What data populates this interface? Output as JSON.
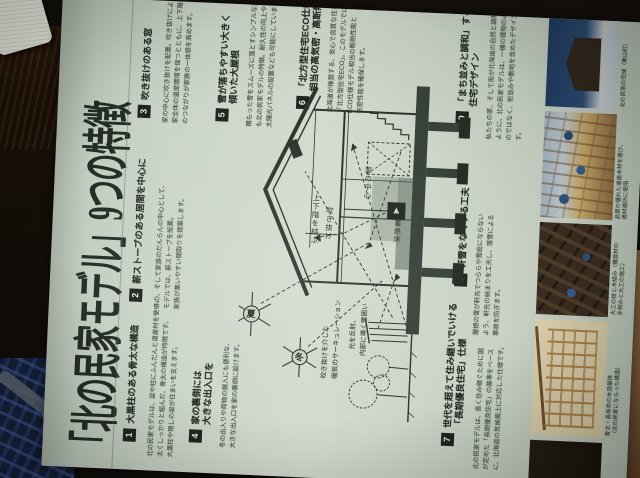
{
  "page": {
    "title": "「北の民家モデル」9つの特徴"
  },
  "colors": {
    "paper": "#ccd5c9",
    "ink": "#2c342c",
    "number_square": "#20261f",
    "table_wood": "#7b5a3a",
    "chair_blue": "#141f38"
  },
  "sections": [
    {
      "num": "1",
      "heading": [
        "大黒柱のある骨太な構造"
      ],
      "body": [
        "北の民家モデルは、梁や柱にふんだんと道産材を使い、",
        "太くしっかりと組んだ、骨太の構造が特徴です。",
        "大黒柱や現しの梁が住まいを支えます。"
      ]
    },
    {
      "num": "2",
      "heading": [
        "薪ストーブのある居間を中心に"
      ],
      "body": [
        "冬の、そして家族のだんらんの中心として、",
        "モデルでは、薪ストーブを設置。",
        "家族が集いやすい間取りを提案します。"
      ]
    },
    {
      "num": "3",
      "heading": [
        "吹き抜けのある窓"
      ],
      "body": [
        "家の中心に吹き抜けを配置。吹き抜けにより、",
        "家全体の温度環境を保つとともに、上下階",
        "のつながりが家族の一体感を高めます。"
      ]
    },
    {
      "num": "4",
      "heading": [
        "家の裏側には",
        "大きな出入口を"
      ],
      "body": [
        "冬の出入りや荷物の搬入にも便利な、",
        "大きな出入口を家の裏側に設けます。"
      ]
    },
    {
      "num": "5",
      "heading": [
        "雪が落ちやすい大きく",
        "傾いた大屋根"
      ],
      "body": [
        "積もった雪をスムーズに落とすシンプルな形",
        "も北の民家モデルの特徴。耐久性の向上や、",
        "太陽光パネルの設置なども可能にしています。"
      ]
    },
    {
      "num": "6",
      "heading": [
        "「北方型住宅ECO仕様」",
        "相当の高気密・高断熱"
      ],
      "body": [
        "北海道が推奨する、安心で良質な住まい",
        "「北方型住宅ECO」。このモデルでは、",
        "ECO仕様モデル相当の断熱性能と",
        "気密性能を確保します。"
      ]
    },
    {
      "num": "7",
      "heading": [
        "世代を超えて住み継いでいける",
        "「長期優良住宅」仕様"
      ],
      "body": [
        "北の民家モデルは、長く住み継ぐために国",
        "が定めた「長期優良住宅」の基準をベース",
        "に、北海道の気候風土に対応した仕様です。"
      ]
    },
    {
      "num": "8",
      "heading": [
        "軒雪をなくする工夫"
      ],
      "body": [
        "屋根の雪が軒先でつららや雪庇にならない",
        "よう、軒先の納まりを工夫し、落雪による",
        "事故を防ぎます。"
      ]
    },
    {
      "num": "9",
      "heading": [
        "「まち並みと調和」する",
        "住宅デザイン"
      ],
      "body": [
        "私たちの家、そして街が北海道の自然と調和する",
        "ように、北の民家モデルは、一棟の建物のみを考える",
        "のではなく、街並みや敷地を含めたデザインとしま",
        "す。"
      ]
    }
  ],
  "diagram": {
    "label_void_1": "上下階を結ぶ",
    "label_void_2": "吹き抜け",
    "label_center": "家の中心",
    "label_floor": "蓄熱床",
    "label_circ_1": "吹き抜けを介した",
    "label_circ_2": "暖気のサーキュレーション",
    "label_light_1": "光を反射、",
    "label_light_2": "内部に導く雪囲い",
    "sun_summer": "夏",
    "sun_winter": "冬"
  },
  "photo_strip": [
    {
      "caption": [
        "北の民家の完成（栗山町）"
      ]
    },
    {
      "caption": [
        "品質の優れた道産木材を選び、",
        "適材適所に使用"
      ]
    },
    {
      "caption": [
        "大工の技と木組み（構造材の",
        "手刻みと大工の施工）"
      ]
    },
    {
      "caption": [
        "骨太・長寿命の木造躯体",
        "（北の民家にならった構造）"
      ]
    }
  ]
}
